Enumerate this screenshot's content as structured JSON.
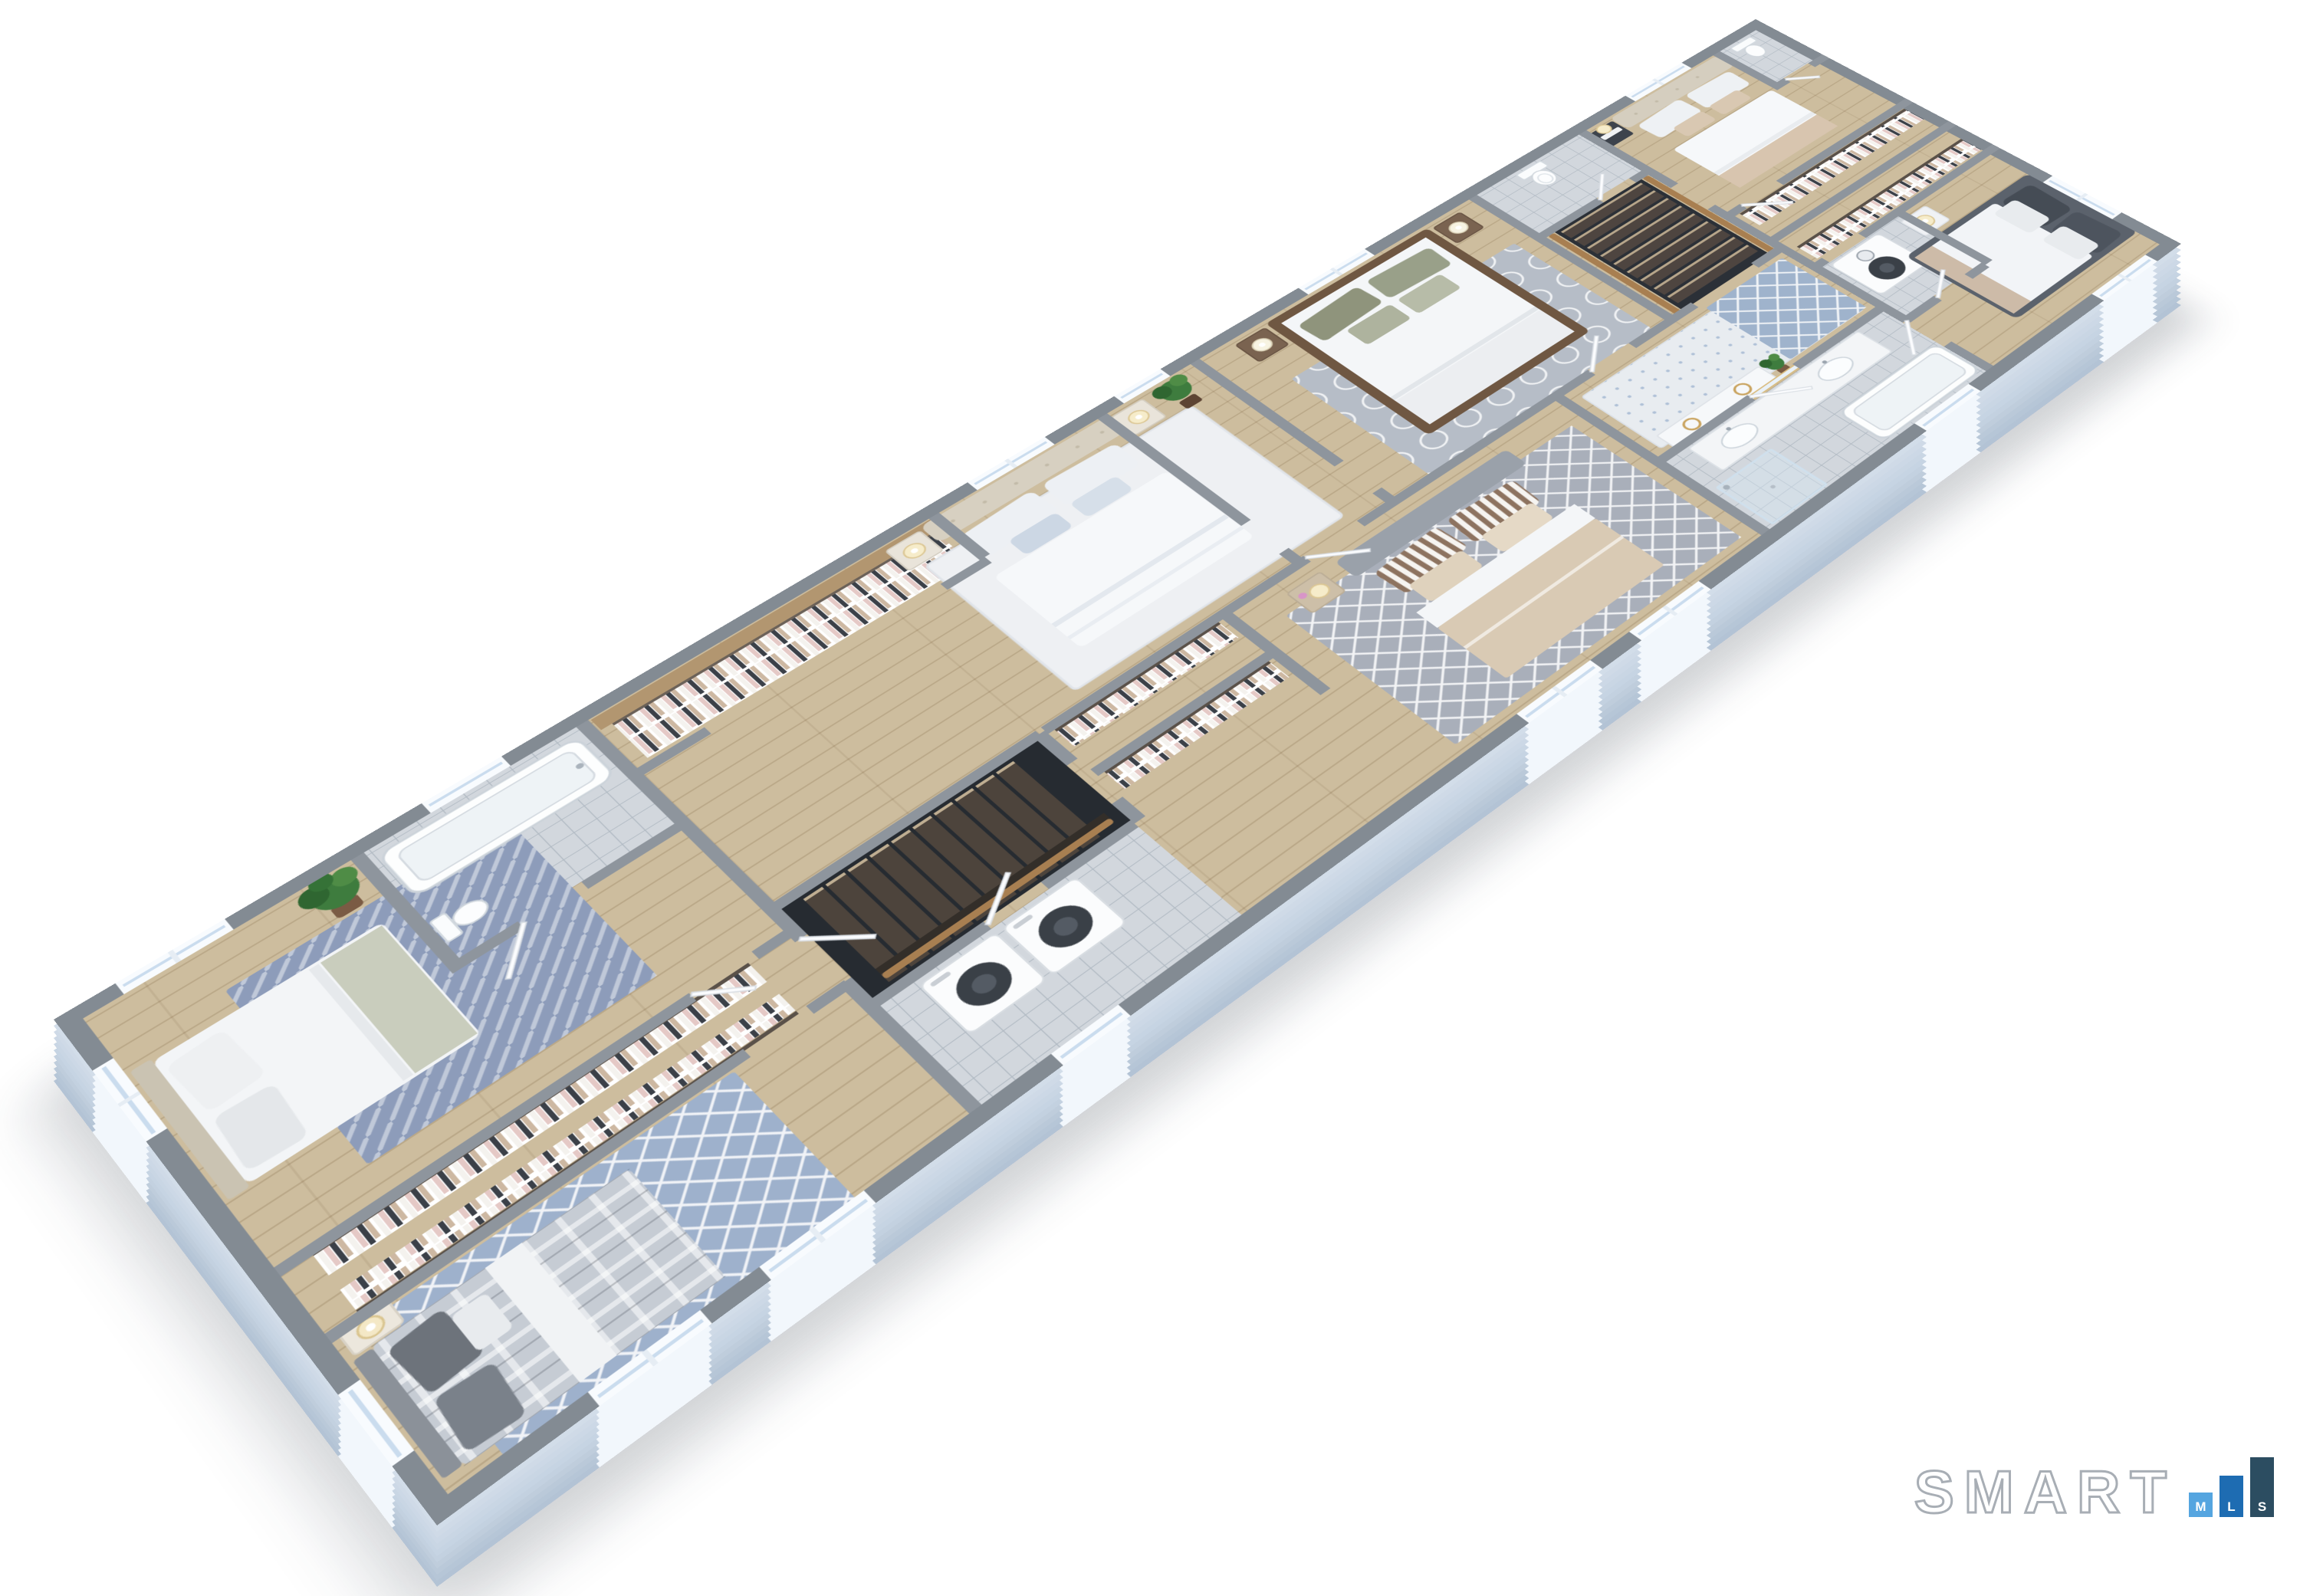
{
  "watermark": {
    "brand_text": "SMART",
    "brand_color": "#ffffff",
    "brand_outline": "#a8aeb5",
    "bars": [
      {
        "letter": "M",
        "color": "#55a5e0"
      },
      {
        "letter": "L",
        "color": "#1e6cb2"
      },
      {
        "letter": "S",
        "color": "#2c4d61"
      }
    ]
  },
  "floorplan": {
    "type": "3d-floor-plan",
    "style": "isometric dollhouse rendering, second floor of a long single-level layout",
    "background": "#ffffff",
    "palette": {
      "wall_top": "#8e959d",
      "wall_face": "#eaeef4",
      "exterior_face": "#c6d4e3",
      "slab_edge": "#b6c6d7",
      "floor_wood": "#cdbd9e",
      "floor_tile": "#d2d7dd",
      "stair_void": "#262b31",
      "railing_wood": "#a87f51",
      "rug_blue": "#9eb1cc",
      "rug_gray": "#a9afba",
      "greenery": "#3e7c3e",
      "bed_linen": "#f4f6f8",
      "dark_bed": "#5b626c",
      "wood_bed_frame": "#6f5742"
    },
    "rooms": [
      {
        "name": "bedroom-west",
        "floor": "wood",
        "furniture": [
          "double bed",
          "herringbone rug",
          "floor plant"
        ]
      },
      {
        "name": "bathroom-west",
        "floor": "tile",
        "furniture": [
          "bathtub",
          "toilet"
        ]
      },
      {
        "name": "closet-corridor-west",
        "floor": "wood",
        "furniture": [
          "clothes racks"
        ]
      },
      {
        "name": "bedroom-southwest",
        "floor": "wood",
        "furniture": [
          "plaid double bed",
          "lattice rug",
          "nightstand with lamp"
        ]
      },
      {
        "name": "walk-in-wardrobe",
        "floor": "wood",
        "furniture": [
          "hanging clothes",
          "wood shelf"
        ]
      },
      {
        "name": "bedroom-center-west",
        "floor": "wood",
        "furniture": [
          "tufted headboard bed",
          "two nightstands",
          "gold lamps",
          "white rug",
          "plant"
        ]
      },
      {
        "name": "staircase-west",
        "floor": "wood treads",
        "furniture": [
          "wood railing"
        ]
      },
      {
        "name": "laundry-west",
        "floor": "tile",
        "furniture": [
          "washer",
          "dryer"
        ]
      },
      {
        "name": "closet-corridor-center",
        "floor": "wood",
        "furniture": [
          "clothes racks"
        ]
      },
      {
        "name": "bedroom-center-south",
        "floor": "wood",
        "furniture": [
          "bed with striped pillows",
          "trellis rug",
          "nightstand with orchid"
        ]
      },
      {
        "name": "bedroom-center-north",
        "floor": "wood",
        "furniture": [
          "dark wood frame bed",
          "olive pillows",
          "circle pattern rug",
          "two nightstands"
        ]
      },
      {
        "name": "hallway",
        "floor": "wood",
        "furniture": [
          "white console with gold rings",
          "runner rug",
          "trellis rug",
          "plant"
        ]
      },
      {
        "name": "bathroom-master",
        "floor": "tile",
        "furniture": [
          "double vanity",
          "gold mirror",
          "bathtub",
          "glass shower"
        ]
      },
      {
        "name": "toilet-room",
        "floor": "tile",
        "furniture": [
          "toilet"
        ]
      },
      {
        "name": "staircase-east",
        "floor": "wood treads",
        "furniture": [
          "wood railings"
        ]
      },
      {
        "name": "bedroom-east-north",
        "floor": "wood",
        "furniture": [
          "tufted headboard bed",
          "dark nightstand",
          "lamp"
        ]
      },
      {
        "name": "bathroom-east",
        "floor": "tile",
        "furniture": [
          "toilet"
        ]
      },
      {
        "name": "closet-corridor-east",
        "floor": "wood",
        "furniture": [
          "clothes racks"
        ]
      },
      {
        "name": "laundry-east",
        "floor": "tile",
        "furniture": [
          "stacked washer dryer"
        ]
      },
      {
        "name": "bedroom-east",
        "floor": "wood",
        "furniture": [
          "dark gray double bed",
          "white nightstand",
          "lamp"
        ]
      }
    ]
  }
}
